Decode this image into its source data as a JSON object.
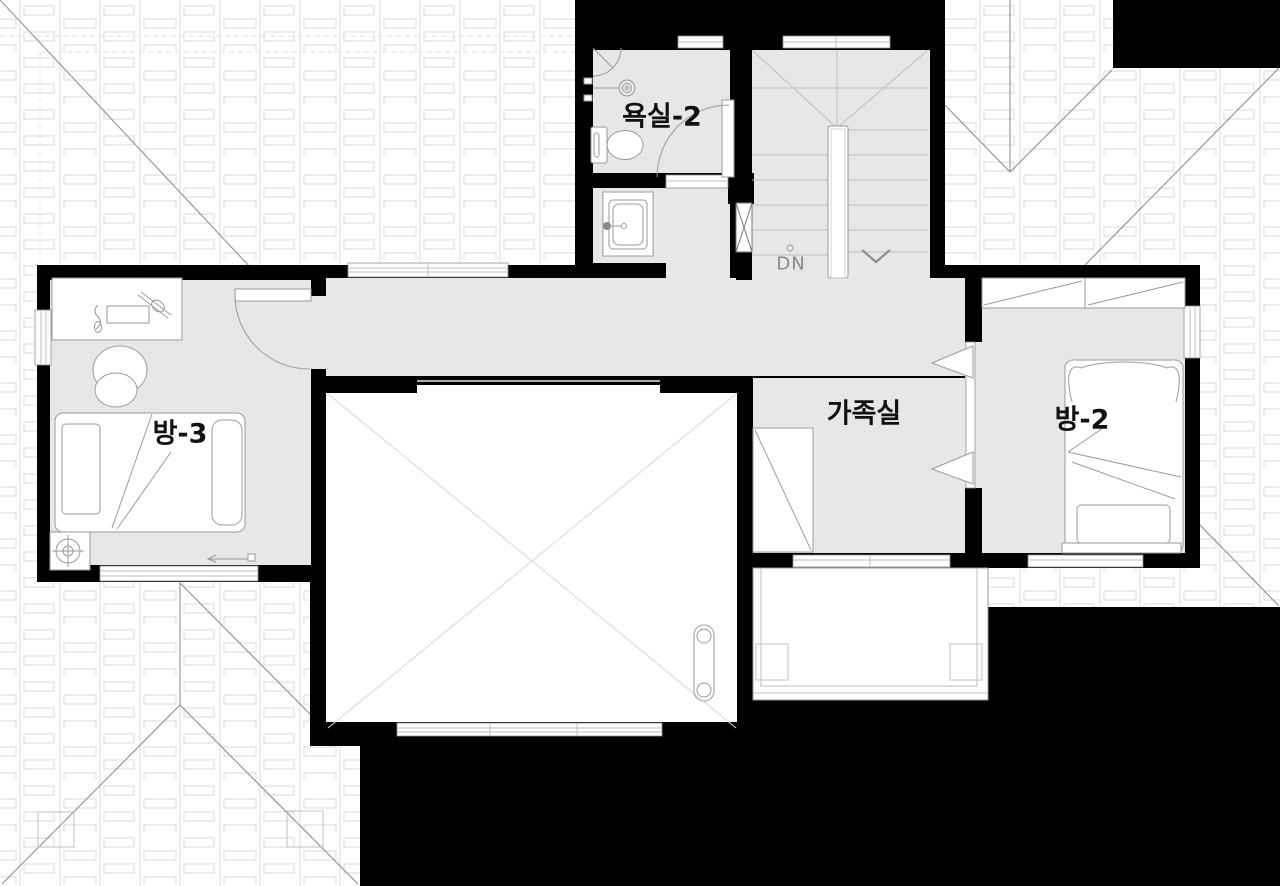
{
  "floorplan": {
    "rooms": [
      {
        "id": "bathroom-2",
        "label": "욕실-2"
      },
      {
        "id": "room-3",
        "label": "방-3"
      },
      {
        "id": "family-room",
        "label": "가족실"
      },
      {
        "id": "room-2",
        "label": "방-2"
      }
    ],
    "stairs": {
      "label": "DN"
    },
    "colors": {
      "background": "#000000",
      "wall": "#000000",
      "floor": "#e7e7e7",
      "line": "#9a9a9a",
      "roof_line": "#8f8f8f",
      "label_text": "#111111",
      "dn_text": "#8a8a8a"
    }
  }
}
